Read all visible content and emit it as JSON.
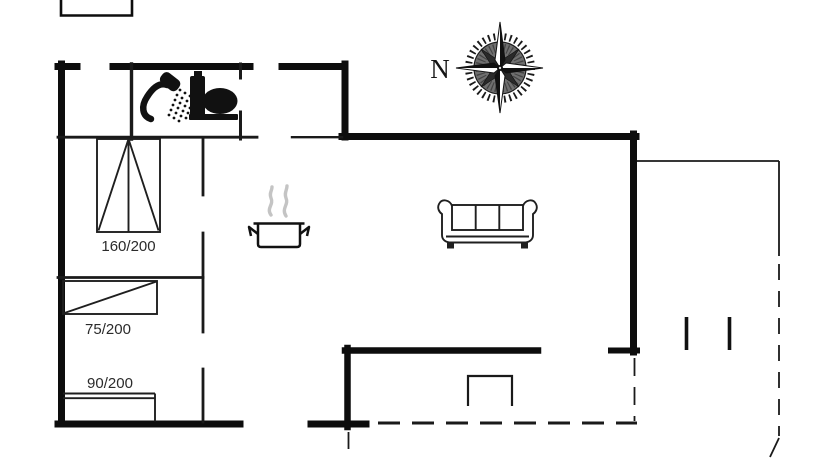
{
  "page": {
    "type": "floor-plan-drawing",
    "background": "#ffffff"
  },
  "compass": {
    "north_label": "N"
  },
  "labels": {
    "bed_double": "160/200",
    "bed_single_left": "75/200",
    "bed_single_bottom": "90/200"
  },
  "icons": {
    "shower": "shower-icon",
    "toilet": "toilet-icon",
    "stove_pot": "steaming-pot-icon",
    "sofa": "sofa-icon",
    "compass_rose": "compass-rose-icon"
  },
  "colors": {
    "wall": "#0d0d0d",
    "interior_wall": "#1a1a1a",
    "furniture_line": "#1f1f1f",
    "steam": "#c4c4c4",
    "label_text": "#2b2b2b"
  }
}
